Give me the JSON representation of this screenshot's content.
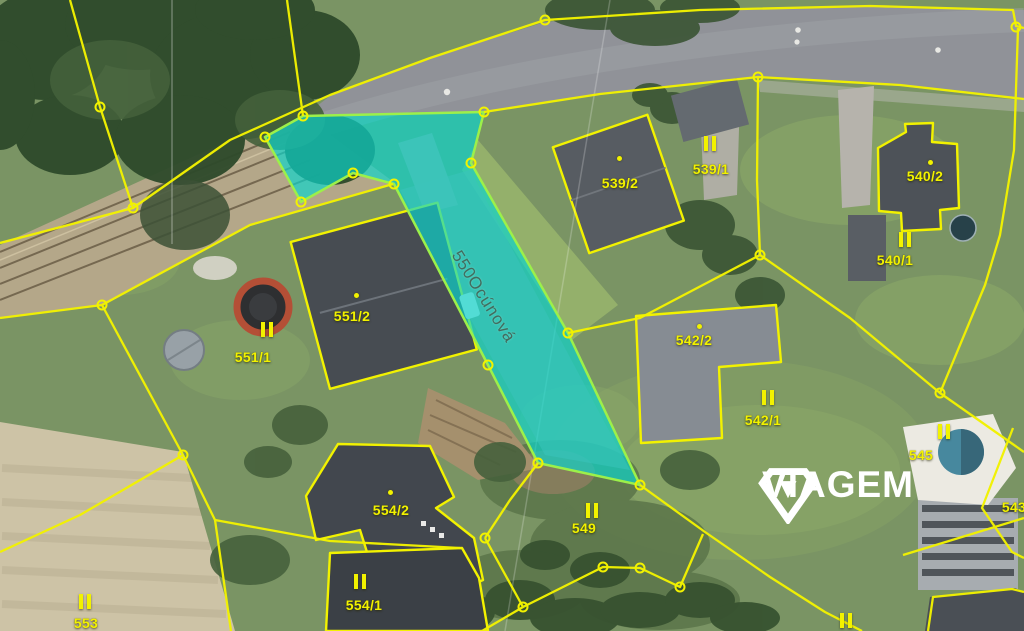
{
  "map_type": "cadastral-aerial",
  "highlight": {
    "parcel_number": "550",
    "street_name": "Ocúnová"
  },
  "parcels": [
    {
      "number": "539/2"
    },
    {
      "number": "539/1"
    },
    {
      "number": "540/2"
    },
    {
      "number": "540/1"
    },
    {
      "number": "551/2"
    },
    {
      "number": "551/1"
    },
    {
      "number": "542/2"
    },
    {
      "number": "542/1"
    },
    {
      "number": "554/2"
    },
    {
      "number": "554/1"
    },
    {
      "number": "553"
    },
    {
      "number": "549"
    },
    {
      "number": "545"
    },
    {
      "number": "543"
    }
  ],
  "watermark": {
    "brand": "VIAGEM"
  },
  "colors": {
    "cadastral_line": "#f2f200",
    "parcel_label": "#f2f200",
    "highlight_fill": "#0ad6cd",
    "highlight_outline": "#9cf04a",
    "street_label": "#44685a",
    "watermark": "#ffffff"
  }
}
